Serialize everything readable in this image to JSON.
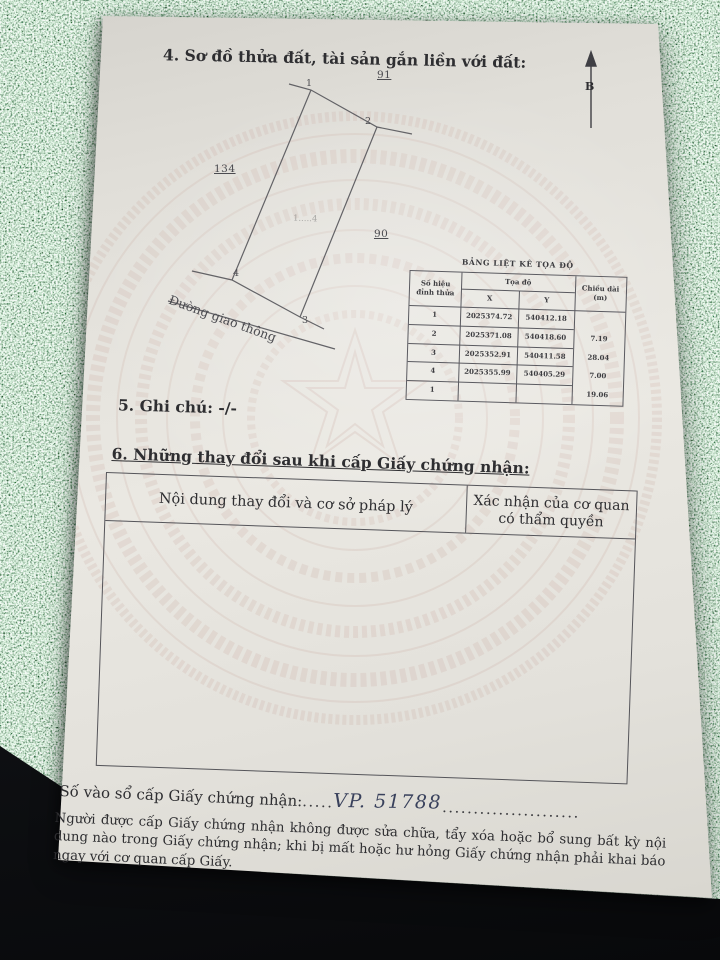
{
  "page": {
    "section4_heading": "4. Sơ đồ thửa đất, tài sản gắn liền với đất:",
    "section5_line": "5. Ghi chú: -/-",
    "section6_heading": "6. Những thay đổi sau khi cấp Giấy chứng nhận:"
  },
  "diagram": {
    "north_label": "B",
    "vertex_labels": [
      "1",
      "2",
      "3",
      "4"
    ],
    "adjacent_parcel_top": "91",
    "adjacent_parcel_left": "134",
    "adjacent_parcel_right": "90",
    "road_label": "Đường giao thông",
    "center_mark": "1.....4"
  },
  "coord_table": {
    "title": "BẢNG LIỆT KÊ TỌA ĐỘ",
    "header": {
      "col1_line1": "Số hiệu",
      "col1_line2": "đỉnh thửa",
      "coords": "Tọa độ",
      "x": "X",
      "y": "Y",
      "length_line1": "Chiều dài",
      "length_line2": "(m)"
    },
    "rows": [
      {
        "id": "1",
        "x": "2025374.72",
        "y": "540412.18"
      },
      {
        "id": "2",
        "x": "2025371.08",
        "y": "540418.60"
      },
      {
        "id": "3",
        "x": "2025352.91",
        "y": "540411.58"
      },
      {
        "id": "4",
        "x": "2025355.99",
        "y": "540405.29"
      },
      {
        "id": "1",
        "x": "",
        "y": ""
      }
    ],
    "lengths": [
      "7.19",
      "28.04",
      "7.00",
      "19.06"
    ]
  },
  "section6_table": {
    "col1_header": "Nội dung thay đổi và cơ sở pháp lý",
    "col2_header_line1": "Xác nhận của cơ quan",
    "col2_header_line2": "có thẩm quyền"
  },
  "registry": {
    "label": "Số vào sổ cấp Giấy chứng nhận:",
    "dots_before": ".....",
    "value": "VP. 51788",
    "dots_after": "......................"
  },
  "footer": {
    "text": "Người được cấp Giấy chứng nhận không được sửa chữa, tẩy xóa hoặc bổ sung bất kỳ nội dung nào trong Giấy chứng nhận; khi bị mất hoặc hư hỏng Giấy chứng nhận phải khai báo ngay với cơ quan cấp Giấy."
  }
}
